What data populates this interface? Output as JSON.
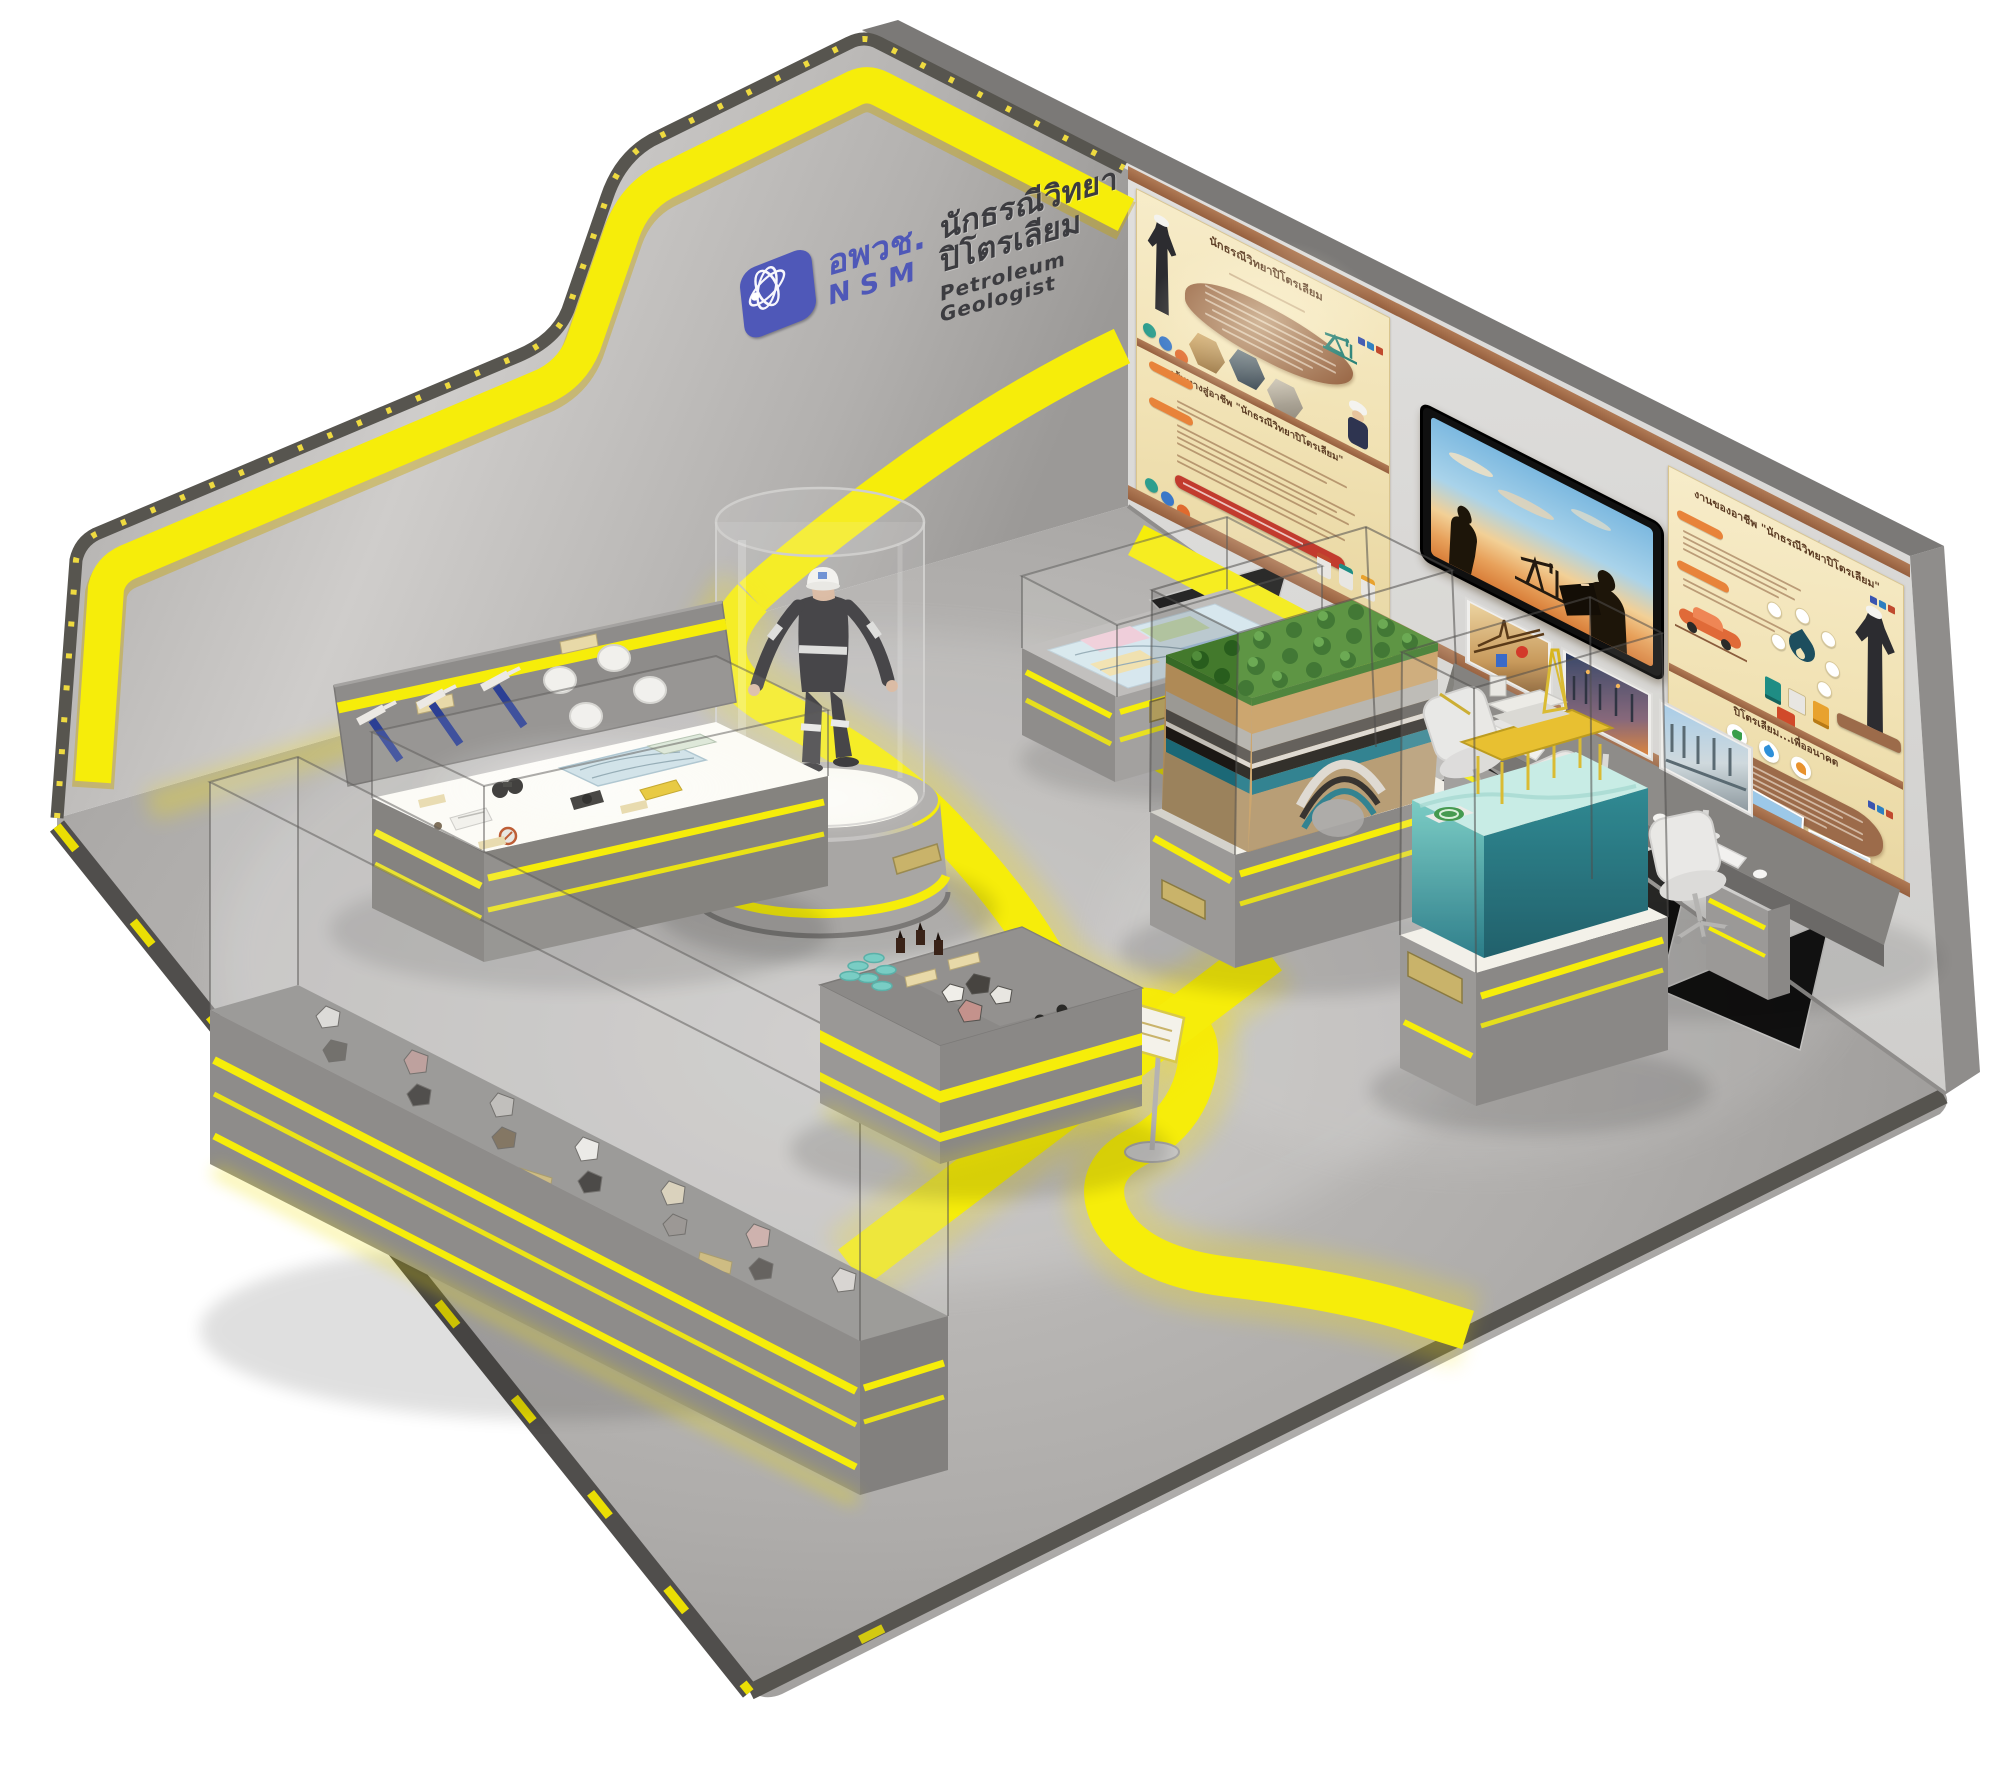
{
  "scene": {
    "exhibit_title_th": "นักธรณีวิทยาปิโตรเลียม",
    "exhibit_title_en": "Petroleum Geologist"
  },
  "logo": {
    "org_abbr_th": "อพวช.",
    "org_abbr_en": "NSM",
    "exhibit_th": "นักธรณีวิทยาปิโตรเลียม",
    "exhibit_en": "Petroleum Geologist"
  },
  "wall_panels": {
    "careers_panel": {
      "title_th": "นักธรณีวิทยาปิโตรเลียม"
    },
    "career_path_panel": {
      "title_th": "เส้นทางสู่อาชีพ \"นักธรณีวิทยาปิโตรเลียม\""
    },
    "jobs_panel": {
      "title_th": "งานของอาชีพ \"นักธรณีวิทยาปิโตรเลียม\""
    },
    "future_panel": {
      "title_th": "ปิโตรเลียม...เพื่ออนาคต"
    }
  },
  "colors": {
    "accent_yellow": "#f6ed0a",
    "logo_blue": "#4f58b8",
    "panel_beige": "#f1e2b4",
    "panel_brown": "#9c6b4a",
    "wall_gray": "#b9b7b5",
    "floor_gray": "#aeacaa",
    "sea_teal": "#1b7f8a",
    "forest_green": "#4e8c33"
  }
}
